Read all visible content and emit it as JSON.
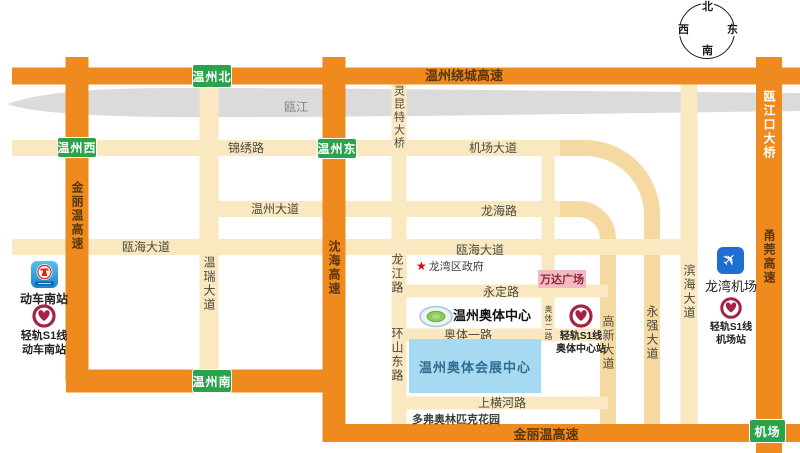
{
  "colors": {
    "highway_orange": "#EF8A1E",
    "road_cream": "#F9E8C0",
    "road_tan": "#F5D9A0",
    "river_gray": "#DBDBDB",
    "exit_green": "#2BA24C",
    "rail_red": "#A32342",
    "metro_blue": "#2D9FE0",
    "airport_blue": "#1E6FD2",
    "expo_blue": "#A6D9F2",
    "wanda_pink": "#F3BAC2",
    "label_dark": "#4A4A3F",
    "highway_label_brown": "#5A3608"
  },
  "compass": {
    "n": "北",
    "s": "南",
    "e": "东",
    "w": "西"
  },
  "river": {
    "label": "瓯江"
  },
  "exits": {
    "north": "温州北",
    "west": "温州西",
    "east": "温州东",
    "south": "温州南",
    "airport": "机场"
  },
  "highways": {
    "raocheng": "温州绕城高速",
    "jinliwen_west": "金丽温高速",
    "shenhai": "沈海高速",
    "oujiangkou_bridge": "瓯江口大桥",
    "yongguan": "甬莞高速",
    "jinliwen_south": "金丽温高速"
  },
  "roads": {
    "jinxiu": "锦绣路",
    "jichang_avenue": "机场大道",
    "wenzhou_avenue": "温州大道",
    "longhai": "龙海路",
    "ouhai_west": "瓯海大道",
    "ouhai_east": "瓯海大道",
    "yongding": "永定路",
    "aoti_1": "奥体一路",
    "shanghenghe": "上横河路",
    "wenrui_avenue": "温瑞大道",
    "lingkun_bridge": "灵昆特大桥",
    "longjiang": "龙江路",
    "huanshandong": "环山东路",
    "aoti_2": "奥体二路",
    "gaoxin_avenue": "高新大道",
    "yongqiang_avenue": "永强大道",
    "binhai_avenue": "滨海大道"
  },
  "landmarks": {
    "train_station": {
      "label": "动车南站"
    },
    "s1_train_station": {
      "line1": "轻轨S1线",
      "line2": "动车南站"
    },
    "longwan_gov": {
      "star": "★",
      "label": "龙湾区政府"
    },
    "wanda": {
      "label": "万达广场"
    },
    "aoti_center": {
      "label": "温州奥体中心"
    },
    "s1_aoti_station": {
      "line1": "轻轨S1线",
      "line2": "奥体中心站"
    },
    "expo_center": {
      "label": "温州奥体会展中心"
    },
    "duofu_garden": {
      "label": "多弗奥林匹克花园"
    },
    "longwan_airport": {
      "label": "龙湾机场"
    },
    "s1_airport_station": {
      "line1": "轻轨S1线",
      "line2": "机场站"
    }
  }
}
